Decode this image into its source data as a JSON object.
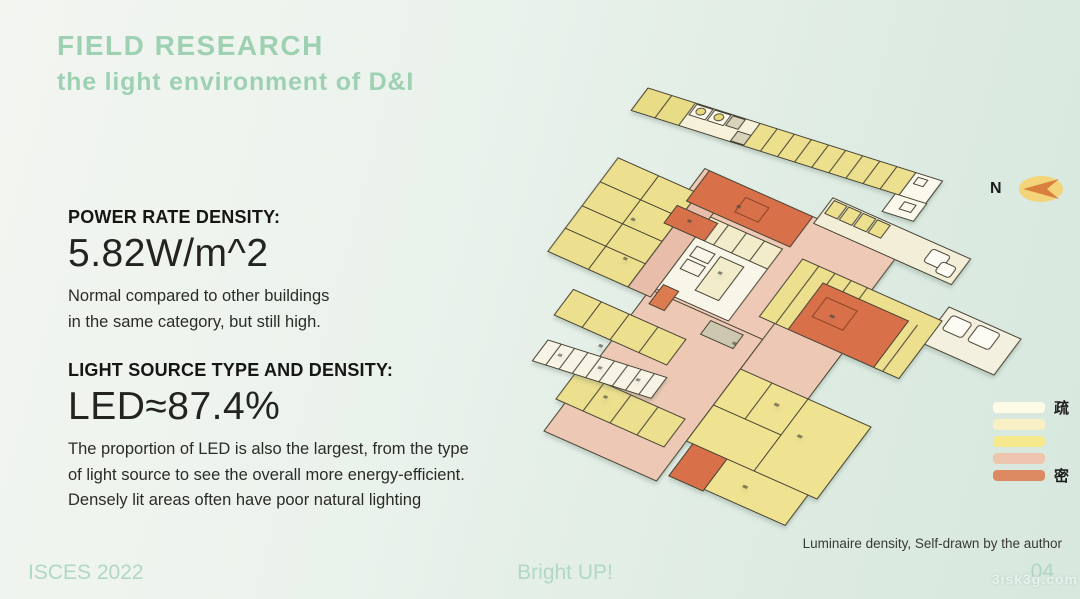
{
  "slide": {
    "title": "FIELD RESEARCH",
    "subtitle": "the light environment of D&I",
    "accent_color": "#9dd1b2",
    "sections": [
      {
        "heading": "POWER RATE DENSITY:",
        "value": "5.82W/m^2",
        "lines": [
          "Normal compared to other buildings",
          "in the same category, but still high."
        ]
      },
      {
        "heading": "LIGHT SOURCE TYPE AND DENSITY:",
        "value": "LED≈87.4%",
        "lines": [
          "The proportion of LED is also the largest, from the type",
          "of light source to see the overall more energy-efficient.",
          "Densely lit areas often have poor natural lighting"
        ]
      }
    ]
  },
  "figure": {
    "type": "floor-plan",
    "compass_label": "N",
    "caption": "Luminaire density, Self-drawn by the author",
    "legend": {
      "top_label": "疏",
      "bottom_label": "密",
      "swatches": [
        "#fdfae6",
        "#f8efc5",
        "#f5e88d",
        "#eec6b0",
        "#dd8a62"
      ]
    },
    "plan_colors": {
      "sparse_room": "#f5f1da",
      "yellow_room": "#ecdf8d",
      "pink_area": "#eecab6",
      "dense_room": "#d8704a",
      "outline": "#454132"
    }
  },
  "footer": {
    "conference": "ISCES 2022",
    "center": "Bright UP!",
    "page": "04",
    "watermark": "3isk3g.com"
  }
}
